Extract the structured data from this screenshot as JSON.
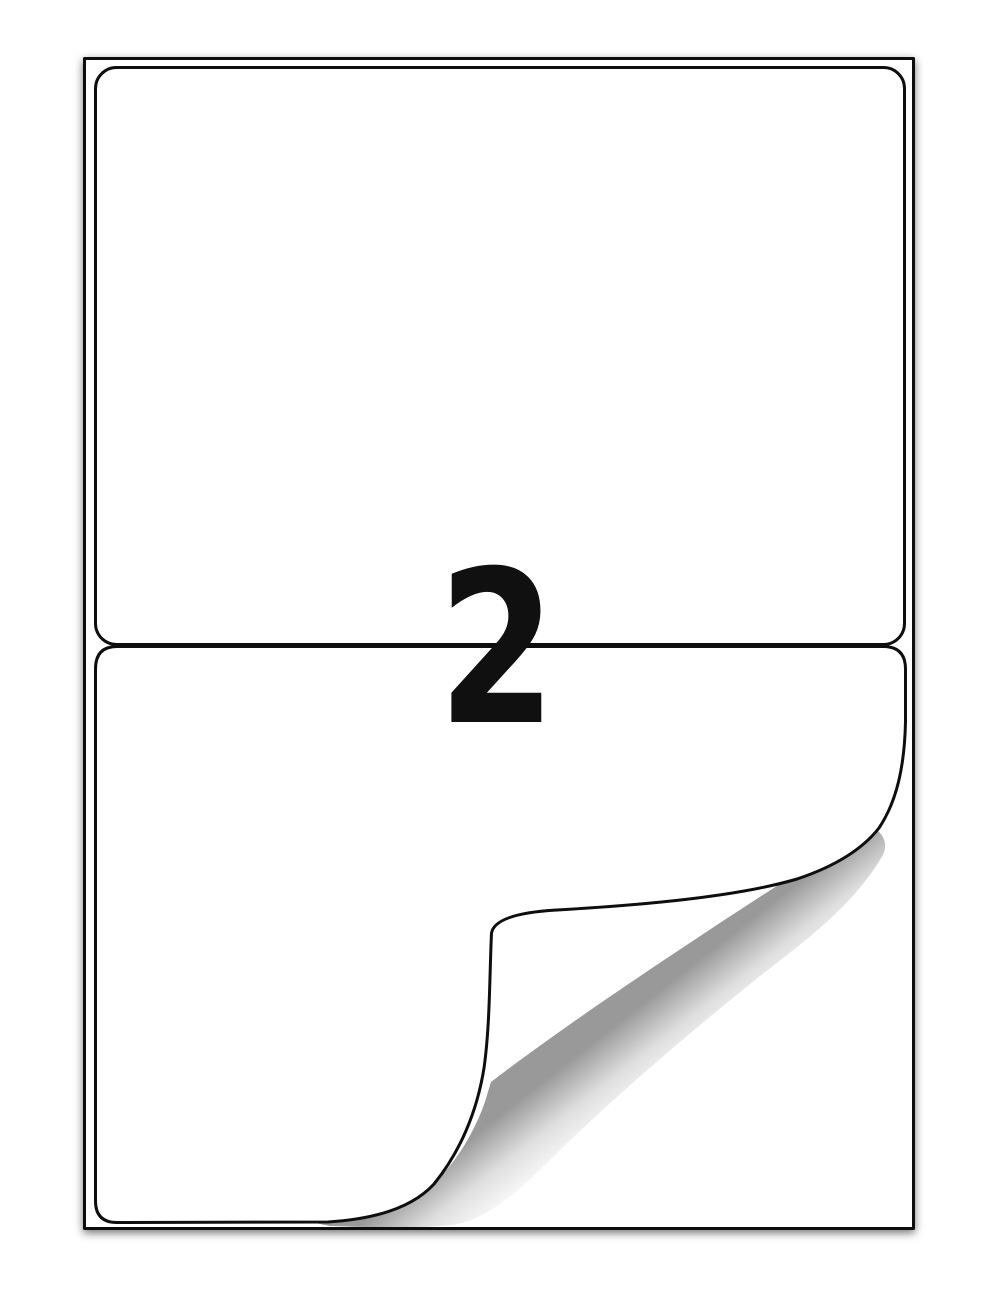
{
  "sheet": {
    "labels_per_sheet_text": "2"
  },
  "colors": {
    "background": "#ffffff",
    "outline": "#0e0e0e",
    "label_fill": "#ffffff",
    "digit": "#101010"
  }
}
